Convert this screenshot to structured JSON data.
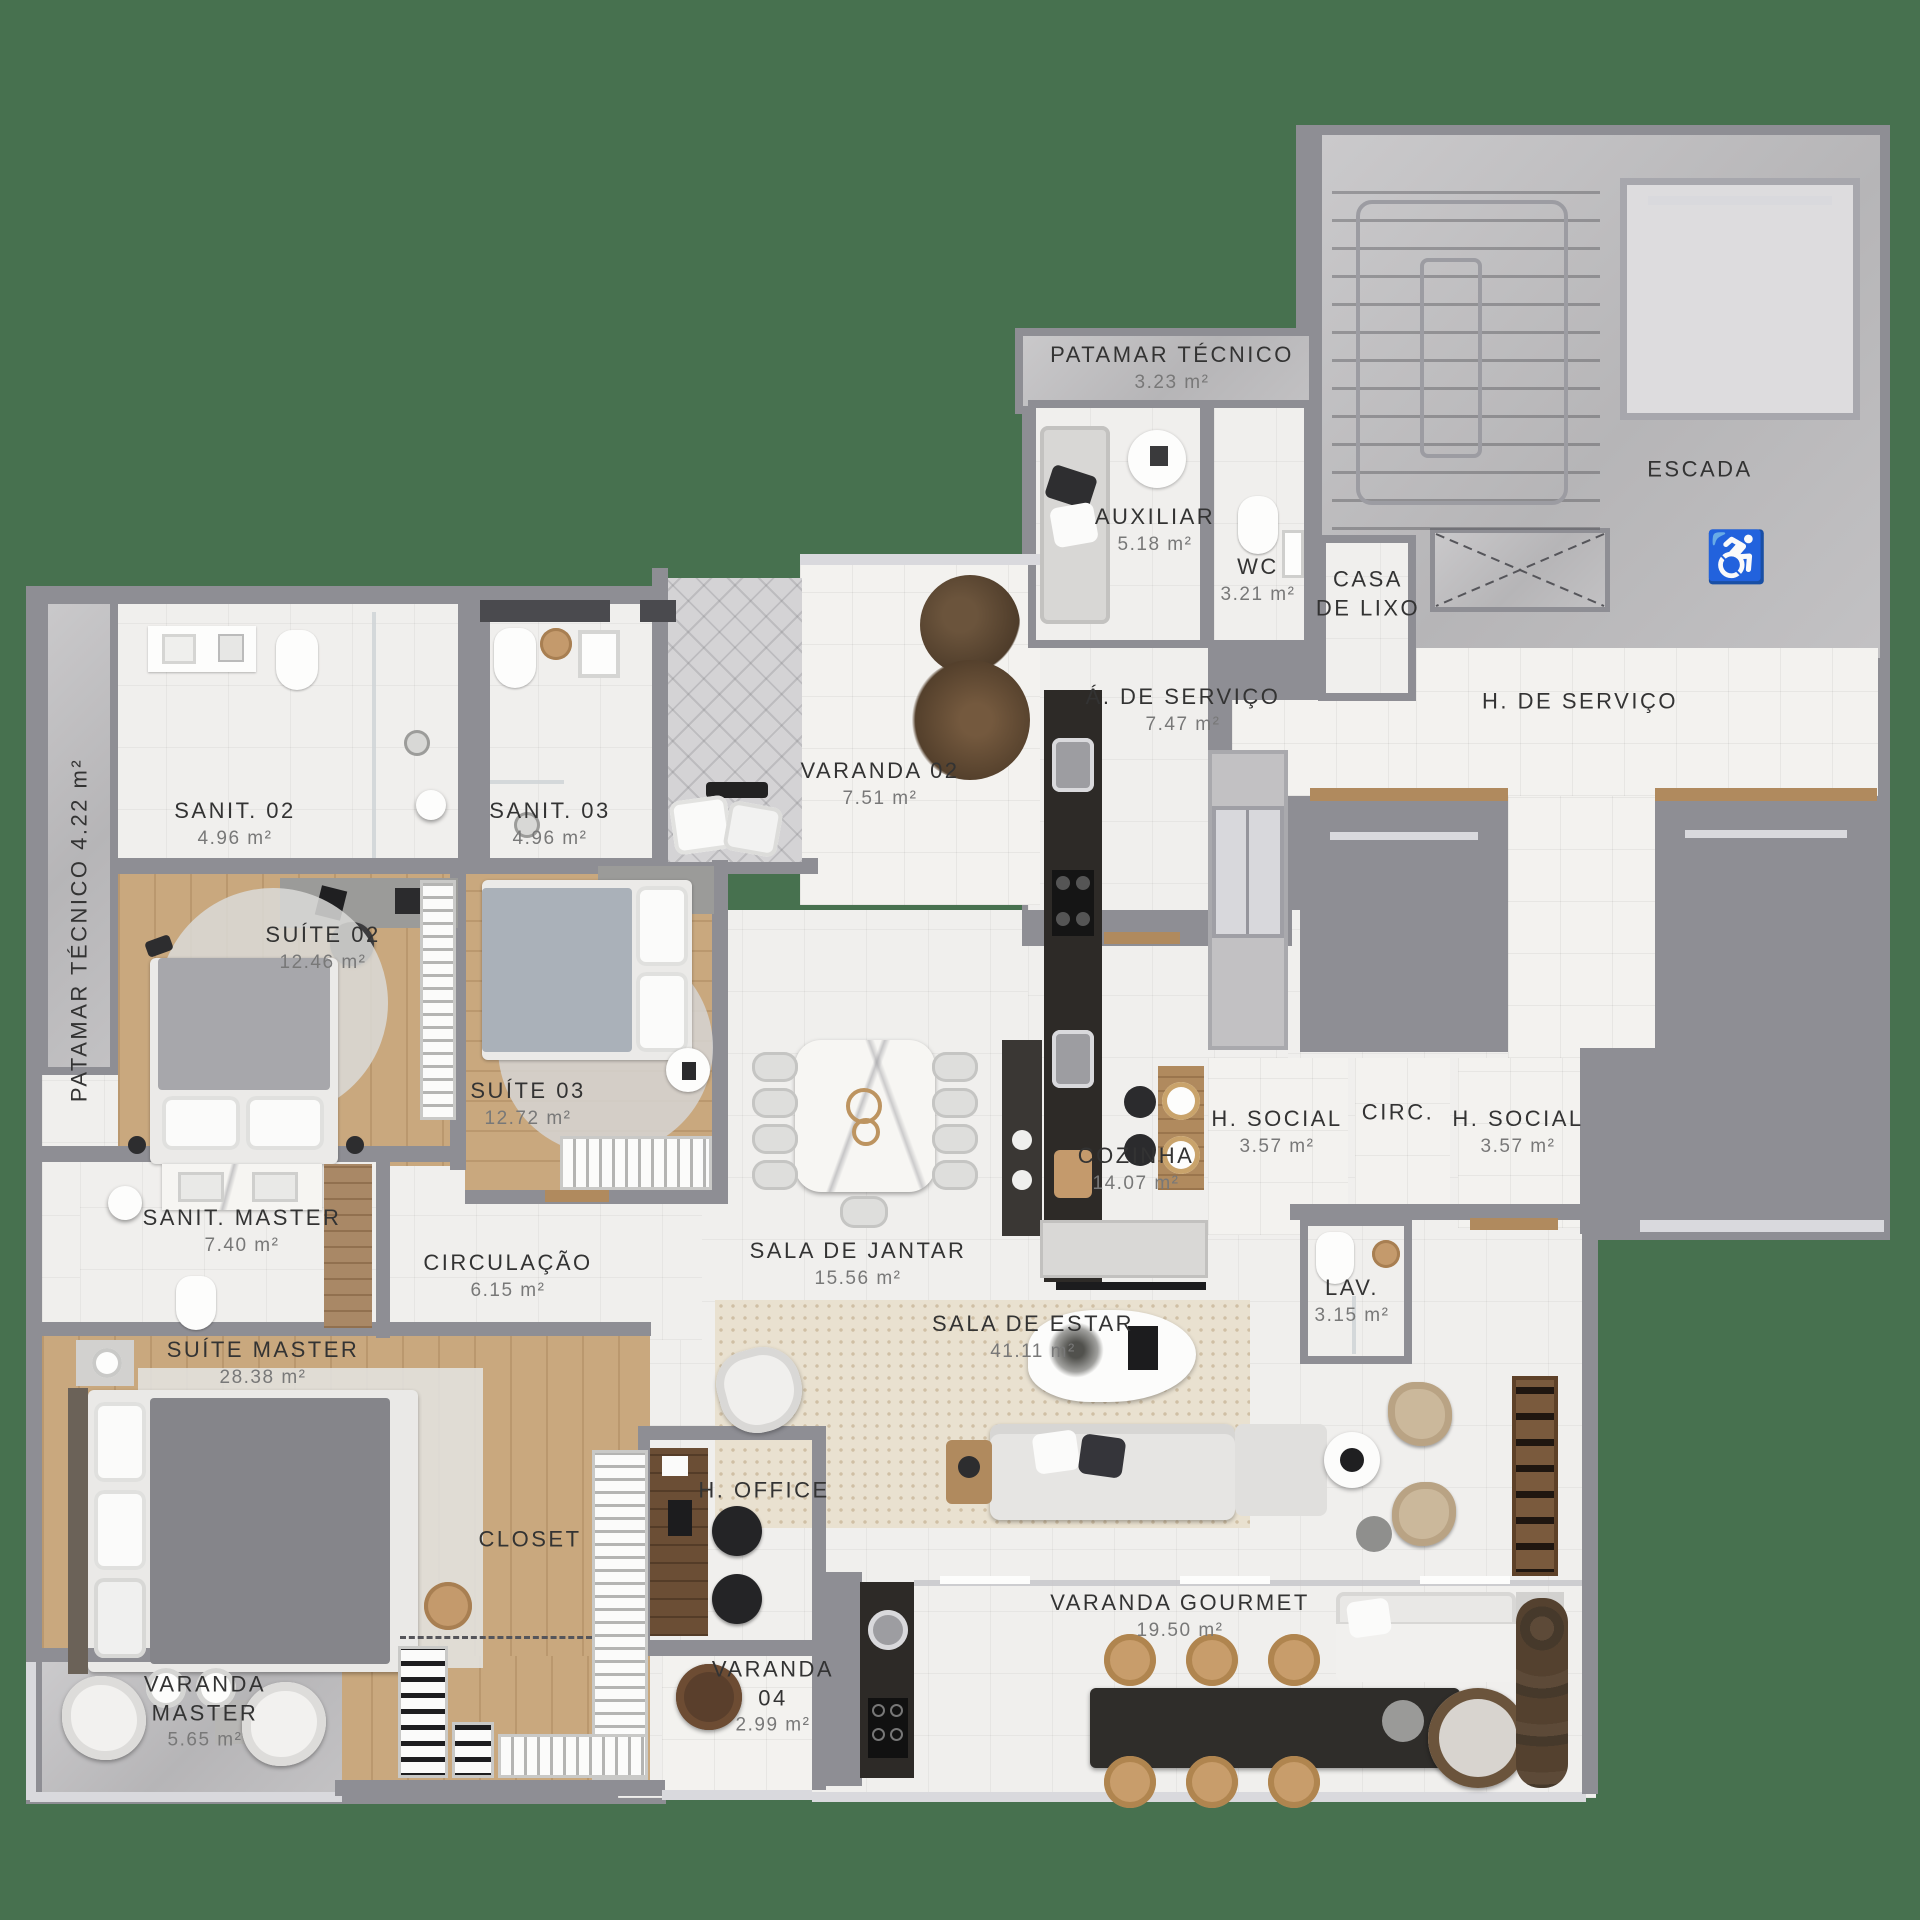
{
  "plan": {
    "background_color": "#47714F",
    "label_color": "#333333",
    "area_color": "#787878",
    "icons": {
      "wheelchair": "♿"
    },
    "rooms": [
      {
        "id": "patamar-tecnico-top",
        "name": "PATAMAR TÉCNICO",
        "area": "3.23 m²",
        "x": 1172,
        "y": 368
      },
      {
        "id": "escada",
        "name": "ESCADA",
        "area": "",
        "x": 1700,
        "y": 470
      },
      {
        "id": "auxiliar",
        "name": "AUXILIAR",
        "area": "5.18 m²",
        "x": 1155,
        "y": 530
      },
      {
        "id": "wc",
        "name": "WC",
        "area": "3.21 m²",
        "x": 1258,
        "y": 580
      },
      {
        "id": "casa-de-lixo",
        "name": "CASA\nDE LIXO",
        "area": "",
        "x": 1368,
        "y": 594
      },
      {
        "id": "a-de-servico",
        "name": "Á. DE SERVIÇO",
        "area": "7.47 m²",
        "x": 1183,
        "y": 710
      },
      {
        "id": "h-de-servico",
        "name": "H. DE SERVIÇO",
        "area": "",
        "x": 1580,
        "y": 702
      },
      {
        "id": "varanda-02",
        "name": "VARANDA 02",
        "area": "7.51 m²",
        "x": 880,
        "y": 784
      },
      {
        "id": "sanit-02",
        "name": "SANIT. 02",
        "area": "4.96 m²",
        "x": 235,
        "y": 824
      },
      {
        "id": "sanit-03",
        "name": "SANIT. 03",
        "area": "4.96 m²",
        "x": 550,
        "y": 824
      },
      {
        "id": "patamar-tecnico-left",
        "name": "PATAMAR TÉCNICO  4.22 m²",
        "area": "",
        "x": 80,
        "y": 930,
        "rot": 90
      },
      {
        "id": "suite-02",
        "name": "SUÍTE 02",
        "area": "12.46 m²",
        "x": 323,
        "y": 948
      },
      {
        "id": "suite-03",
        "name": "SUÍTE 03",
        "area": "12.72 m²",
        "x": 528,
        "y": 1104
      },
      {
        "id": "cozinha",
        "name": "COZINHA",
        "area": "14.07 m²",
        "x": 1136,
        "y": 1169
      },
      {
        "id": "h-social-left",
        "name": "H. SOCIAL",
        "area": "3.57 m²",
        "x": 1277,
        "y": 1132
      },
      {
        "id": "circ",
        "name": "CIRC.",
        "area": "",
        "x": 1398,
        "y": 1113
      },
      {
        "id": "h-social-right",
        "name": "H. SOCIAL",
        "area": "3.57 m²",
        "x": 1518,
        "y": 1132
      },
      {
        "id": "sanit-master",
        "name": "SANIT. MASTER",
        "area": "7.40 m²",
        "x": 242,
        "y": 1231
      },
      {
        "id": "circulacao",
        "name": "CIRCULAÇÃO",
        "area": "6.15 m²",
        "x": 508,
        "y": 1276
      },
      {
        "id": "sala-de-jantar",
        "name": "SALA DE JANTAR",
        "area": "15.56 m²",
        "x": 858,
        "y": 1264
      },
      {
        "id": "lav",
        "name": "LAV.",
        "area": "3.15 m²",
        "x": 1352,
        "y": 1301
      },
      {
        "id": "sala-de-estar",
        "name": "SALA DE ESTAR",
        "area": "41.11 m²",
        "x": 1033,
        "y": 1337
      },
      {
        "id": "suite-master",
        "name": "SUÍTE MASTER",
        "area": "28.38 m²",
        "x": 263,
        "y": 1363
      },
      {
        "id": "h-office",
        "name": "H. OFFICE",
        "area": "",
        "x": 764,
        "y": 1491
      },
      {
        "id": "closet",
        "name": "CLOSET",
        "area": "",
        "x": 530,
        "y": 1540
      },
      {
        "id": "varanda-gourmet",
        "name": "VARANDA GOURMET",
        "area": "19.50 m²",
        "x": 1180,
        "y": 1616
      },
      {
        "id": "varanda-master",
        "name": "VARANDA\nMASTER",
        "area": "5.65 m²",
        "x": 205,
        "y": 1712
      },
      {
        "id": "varanda-04",
        "name": "VARANDA\n04",
        "area": "2.99 m²",
        "x": 773,
        "y": 1697
      }
    ]
  }
}
